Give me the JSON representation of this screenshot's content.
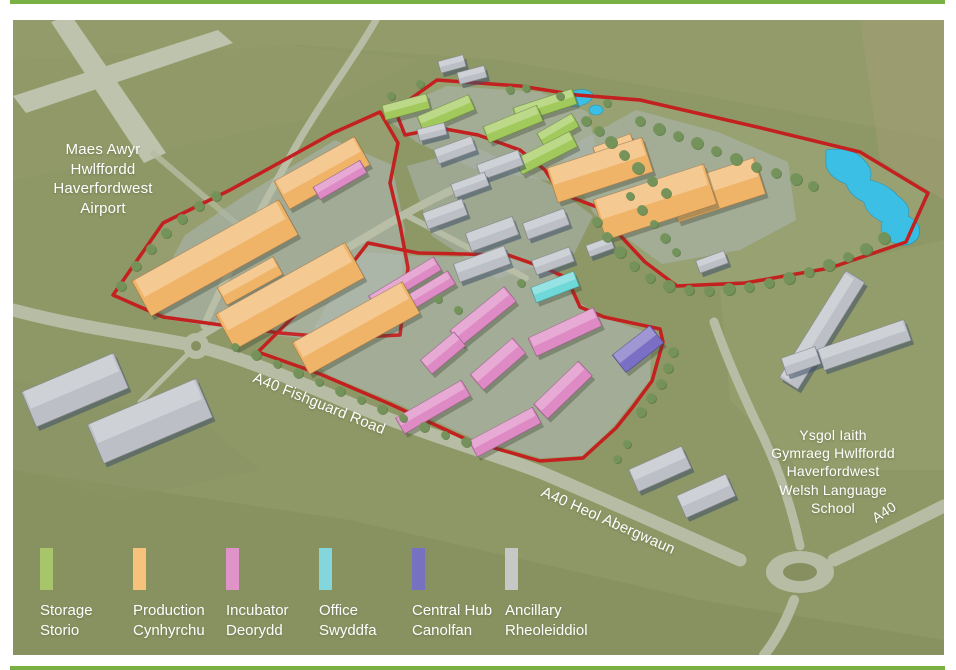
{
  "page": {
    "border_color": "#79b144",
    "background": "#ffffff"
  },
  "map": {
    "x": 13,
    "y": 20,
    "w": 931,
    "h": 635,
    "background": "#8e9766",
    "boundary_color": "#c32020",
    "road_color": "#b7bda4",
    "runway_color": "#bdc3ac",
    "water_color": "#35bde4",
    "tree_color": "#75935b",
    "tree_shadow": "#597943",
    "hardstand_color": "#a9b2ac",
    "building_colors": {
      "storage": "#a2c95c",
      "production": "#f0b469",
      "incubator": "#de8ac4",
      "office": "#6fd8d8",
      "hub": "#7a6fc4",
      "existing": "#bcc0c6"
    },
    "patches": [
      {
        "points": "13,20 944,20 944,140 700,95 500,60 300,45 13,60",
        "fill": "#97a06d",
        "op": 0.5
      },
      {
        "points": "860,20 944,20 944,200 880,160",
        "fill": "#a39d72",
        "op": 0.55
      },
      {
        "points": "720,290 944,240 944,470 800,470 730,400",
        "fill": "#9aa171",
        "op": 0.45
      },
      {
        "points": "13,470 350,520 700,600 944,640 944,655 13,655",
        "fill": "#838e5d",
        "op": 0.55
      },
      {
        "points": "13,60 240,40 420,60 300,120 120,160 13,180",
        "fill": "#939c6a",
        "op": 0.5
      },
      {
        "points": "13,380 200,420 260,470 120,500 13,470",
        "fill": "#8a9464",
        "op": 0.5
      }
    ],
    "runways": [
      "13,96 218,30 233,43 26,113",
      "51,22 71,15 166,153 144,163"
    ],
    "taxiway": "M 152 152 Q 208 200 258 242",
    "zone_tints": [
      {
        "use": "north",
        "fill": "#9aa573",
        "op": 0.5
      },
      {
        "use": "west",
        "fill": "#9aa171",
        "op": 0.3
      },
      {
        "use": "south",
        "fill": "#9fa678",
        "op": 0.35
      }
    ],
    "hardstands": [
      "150,300 185,235 245,195 335,140 392,165 405,230 398,330 330,342 235,330 170,320",
      "382,115 447,86 540,92 588,112 596,150 560,183 472,168 416,142",
      "560,152 636,110 718,132 788,162 796,220 740,250 662,264 594,214",
      "407,166 476,147 553,186 593,216 574,254 497,279 432,236",
      "362,252 420,256 508,258 552,272 576,300 600,316 652,334 650,380 628,408 612,428 582,456 540,458 472,438 394,402 330,376 300,352 330,300"
    ],
    "roads": [
      {
        "d": "M 13 310 C 90 330 150 336 196 346 C 258 362 306 386 366 410 C 430 436 488 452 540 472 C 588 492 650 520 740 560",
        "w": 13
      },
      {
        "d": "M 834 560 C 868 544 900 528 944 506",
        "w": 13
      },
      {
        "d": "M 800 546 C 790 500 776 462 756 422 C 740 388 726 356 714 322",
        "w": 9
      },
      {
        "d": "M 794 600 C 786 622 776 640 764 655",
        "w": 10
      },
      {
        "d": "M 200 336 C 256 302 330 258 398 218 C 448 190 500 167 544 152",
        "w": 8
      },
      {
        "d": "M 404 214 C 446 236 492 260 526 278",
        "w": 6
      },
      {
        "d": "M 376 20 C 352 62 322 100 296 146 C 270 192 232 262 204 326",
        "w": 7
      },
      {
        "d": "M 192 350 C 176 366 158 384 140 402",
        "w": 5
      }
    ],
    "roundabouts": [
      {
        "cx": 800,
        "cy": 572,
        "rx": 34,
        "ry": 21,
        "irx": 17,
        "iry": 9
      },
      {
        "cx": 196,
        "cy": 346,
        "rx": 13,
        "ry": 13,
        "irx": 5,
        "iry": 5
      }
    ],
    "ponds": {
      "ellipses": [
        {
          "cx": 578,
          "cy": 98,
          "rx": 15,
          "ry": 8,
          "rot": -12
        },
        {
          "cx": 596,
          "cy": 110,
          "rx": 7,
          "ry": 5,
          "rot": 0
        }
      ],
      "path": "M 826 150 Q 852 146 864 160 Q 874 170 870 180 Q 888 184 898 196 Q 912 206 908 216 Q 924 224 918 238 Q 908 250 892 242 Q 878 234 882 222 Q 866 214 864 202 Q 850 196 846 184 Q 830 178 826 166 Z"
    },
    "boundaries": {
      "north": "395,110 437,80 520,86 577,95 640,100 757,127 860,152 928,193 906,242 830,268 745,283 677,286 645,262 616,231 597,207 560,193 545,170 520,150 478,135 440,128 405,135",
      "west": "113,295 163,223 230,190 333,133 380,112 398,143 390,183 400,225 408,268 400,335 340,338 280,333 163,317",
      "south": "368,243 418,253 508,255 545,268 567,278 580,307 604,317 660,329 663,342 652,381 632,408 616,428 583,458 540,461 470,441 390,404 320,374 258,352 292,318 330,283 354,261"
    },
    "buildings": [
      [
        "storage",
        406,
        107,
        46,
        15,
        -15
      ],
      [
        "storage",
        446,
        113,
        56,
        16,
        -23
      ],
      [
        "storage",
        513,
        124,
        58,
        17,
        -22
      ],
      [
        "storage",
        545,
        106,
        62,
        16,
        -18
      ],
      [
        "storage",
        558,
        130,
        40,
        15,
        -30
      ],
      [
        "storage",
        546,
        153,
        62,
        17,
        -27
      ],
      [
        "production",
        600,
        170,
        100,
        36,
        -18
      ],
      [
        "production",
        655,
        202,
        116,
        42,
        -18
      ],
      [
        "production",
        716,
        190,
        92,
        38,
        -18
      ],
      [
        "production",
        615,
        150,
        40,
        20,
        -20
      ],
      [
        "production",
        215,
        258,
        168,
        40,
        -29
      ],
      [
        "production",
        290,
        296,
        148,
        40,
        -29
      ],
      [
        "production",
        356,
        328,
        126,
        36,
        -29
      ],
      [
        "production",
        322,
        173,
        92,
        32,
        -29
      ],
      [
        "production",
        250,
        281,
        64,
        20,
        -29
      ],
      [
        "incubator",
        340,
        180,
        54,
        14,
        -30
      ],
      [
        "incubator",
        405,
        283,
        76,
        15,
        -31
      ],
      [
        "incubator",
        419,
        297,
        76,
        15,
        -31
      ],
      [
        "incubator",
        483,
        316,
        70,
        19,
        -39
      ],
      [
        "incubator",
        443,
        353,
        44,
        18,
        -40
      ],
      [
        "incubator",
        498,
        364,
        56,
        20,
        -41
      ],
      [
        "incubator",
        565,
        332,
        72,
        20,
        -25
      ],
      [
        "incubator",
        563,
        390,
        62,
        20,
        -44
      ],
      [
        "incubator",
        433,
        407,
        76,
        18,
        -30
      ],
      [
        "incubator",
        505,
        432,
        72,
        18,
        -28
      ],
      [
        "office",
        555,
        287,
        46,
        16,
        -21
      ],
      [
        "hub",
        638,
        349,
        48,
        22,
        -38
      ],
      [
        "existing",
        452,
        64,
        26,
        12,
        -15
      ],
      [
        "existing",
        472,
        75,
        28,
        12,
        -15
      ],
      [
        "existing",
        432,
        132,
        28,
        12,
        -14
      ],
      [
        "existing",
        455,
        150,
        40,
        15,
        -20
      ],
      [
        "existing",
        500,
        165,
        44,
        16,
        -20
      ],
      [
        "existing",
        470,
        185,
        36,
        14,
        -20
      ],
      [
        "existing",
        445,
        214,
        42,
        17,
        -20
      ],
      [
        "existing",
        492,
        234,
        50,
        19,
        -20
      ],
      [
        "existing",
        546,
        224,
        44,
        17,
        -20
      ],
      [
        "existing",
        482,
        264,
        54,
        19,
        -20
      ],
      [
        "existing",
        553,
        261,
        40,
        15,
        -20
      ],
      [
        "existing",
        600,
        247,
        26,
        12,
        -20
      ],
      [
        "existing",
        712,
        262,
        30,
        13,
        -20
      ],
      [
        "existing",
        75,
        390,
        100,
        38,
        -23
      ],
      [
        "existing",
        150,
        421,
        118,
        42,
        -23
      ],
      [
        "existing",
        660,
        469,
        58,
        24,
        -24
      ],
      [
        "existing",
        706,
        496,
        54,
        24,
        -24
      ],
      [
        "existing",
        822,
        330,
        126,
        22,
        -58
      ],
      [
        "existing",
        864,
        345,
        92,
        22,
        -19
      ],
      [
        "existing",
        801,
        361,
        36,
        18,
        -19
      ]
    ],
    "trees": [
      [
        640,
        121,
        5
      ],
      [
        659,
        129,
        6
      ],
      [
        678,
        136,
        5
      ],
      [
        697,
        143,
        6
      ],
      [
        716,
        151,
        5
      ],
      [
        736,
        159,
        6
      ],
      [
        756,
        167,
        5
      ],
      [
        776,
        173,
        5
      ],
      [
        796,
        179,
        6
      ],
      [
        813,
        186,
        5
      ],
      [
        884,
        238,
        6
      ],
      [
        866,
        249,
        6
      ],
      [
        848,
        257,
        5
      ],
      [
        829,
        265,
        6
      ],
      [
        809,
        272,
        5
      ],
      [
        789,
        278,
        6
      ],
      [
        769,
        283,
        5
      ],
      [
        749,
        287,
        5
      ],
      [
        729,
        289,
        6
      ],
      [
        709,
        291,
        5
      ],
      [
        689,
        290,
        5
      ],
      [
        669,
        286,
        6
      ],
      [
        650,
        278,
        5
      ],
      [
        634,
        266,
        5
      ],
      [
        620,
        252,
        6
      ],
      [
        607,
        237,
        5
      ],
      [
        597,
        222,
        5
      ],
      [
        586,
        121,
        5
      ],
      [
        599,
        131,
        5
      ],
      [
        611,
        142,
        6
      ],
      [
        624,
        155,
        5
      ],
      [
        638,
        168,
        6
      ],
      [
        652,
        181,
        5
      ],
      [
        666,
        193,
        5
      ],
      [
        630,
        196,
        4
      ],
      [
        642,
        210,
        5
      ],
      [
        654,
        224,
        4
      ],
      [
        665,
        238,
        5
      ],
      [
        676,
        252,
        4
      ],
      [
        121,
        286,
        5
      ],
      [
        136,
        266,
        5
      ],
      [
        151,
        249,
        5
      ],
      [
        166,
        233,
        5
      ],
      [
        182,
        219,
        5
      ],
      [
        199,
        206,
        5
      ],
      [
        216,
        196,
        5
      ],
      [
        235,
        347,
        4
      ],
      [
        256,
        355,
        5
      ],
      [
        277,
        364,
        4
      ],
      [
        298,
        373,
        5
      ],
      [
        319,
        382,
        4
      ],
      [
        340,
        391,
        5
      ],
      [
        361,
        400,
        4
      ],
      [
        382,
        409,
        5
      ],
      [
        403,
        418,
        4
      ],
      [
        424,
        427,
        5
      ],
      [
        445,
        435,
        4
      ],
      [
        466,
        442,
        5
      ],
      [
        673,
        352,
        5
      ],
      [
        668,
        368,
        5
      ],
      [
        661,
        384,
        5
      ],
      [
        651,
        398,
        5
      ],
      [
        641,
        412,
        5
      ],
      [
        560,
        96,
        4
      ],
      [
        607,
        103,
        4
      ],
      [
        510,
        90,
        4
      ],
      [
        526,
        88,
        4
      ],
      [
        391,
        96,
        4
      ],
      [
        420,
        84,
        4
      ],
      [
        438,
        299,
        4
      ],
      [
        458,
        310,
        4
      ],
      [
        521,
        283,
        4
      ],
      [
        627,
        444,
        4
      ],
      [
        617,
        459,
        4
      ]
    ],
    "labels": [
      {
        "name": "airport-label",
        "x": 103,
        "y": 140,
        "size": 15,
        "rot": 0,
        "lines": [
          "Maes Awyr",
          "Hwlffordd",
          "Haverfordwest",
          "Airport"
        ]
      },
      {
        "name": "school-label",
        "x": 833,
        "y": 426,
        "size": 14,
        "rot": 0,
        "lines": [
          "Ysgol Iaith",
          "Gymraeg Hwlffordd",
          "Haverfordwest",
          "Welsh Language",
          "School"
        ]
      },
      {
        "name": "road-label-fishguard",
        "x": 319,
        "y": 404,
        "size": 15,
        "rot": 22,
        "lines": [
          "A40 Fishguard Road"
        ]
      },
      {
        "name": "road-label-abergwaun",
        "x": 608,
        "y": 521,
        "size": 15,
        "rot": 24,
        "lines": [
          "A40 Heol Abergwaun"
        ]
      },
      {
        "name": "road-label-a40",
        "x": 884,
        "y": 512,
        "size": 14,
        "rot": -33,
        "lines": [
          "A40"
        ]
      }
    ]
  },
  "legend": {
    "items": [
      {
        "en": "Storage",
        "cy": "Storio",
        "color": "#a9c56b",
        "x": 40
      },
      {
        "en": "Production",
        "cy": "Cynhyrchu",
        "color": "#f6c27c",
        "x": 133
      },
      {
        "en": "Incubator",
        "cy": "Deorydd",
        "color": "#df93c8",
        "x": 226
      },
      {
        "en": "Office",
        "cy": "Swyddfa",
        "color": "#82d6dc",
        "x": 319
      },
      {
        "en": "Central Hub",
        "cy": "Canolfan",
        "color": "#7672c1",
        "x": 412
      },
      {
        "en": "Ancillary",
        "cy": "Rheoleiddiol",
        "color": "#c7c8c6",
        "x": 505
      }
    ]
  }
}
